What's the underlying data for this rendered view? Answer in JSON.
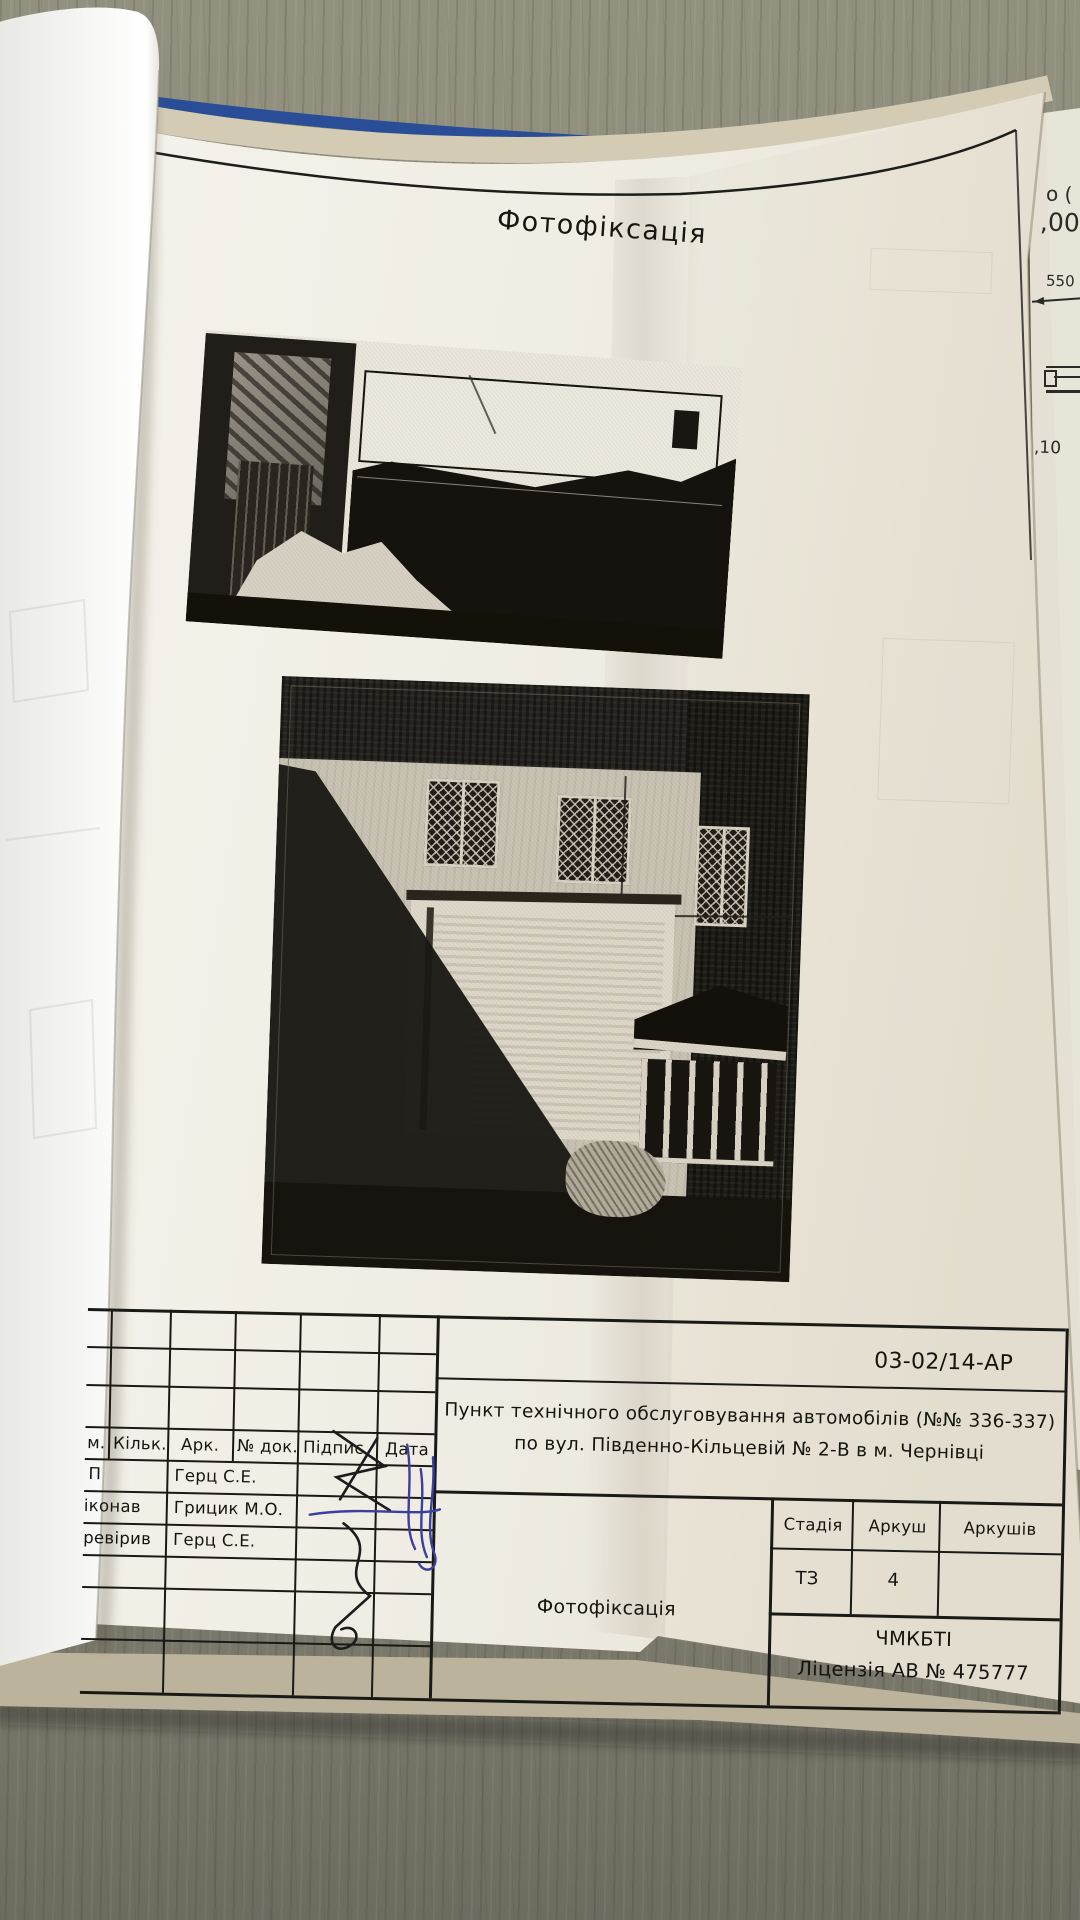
{
  "document": {
    "page_title": "Фотофіксація",
    "doc_code": "03-02/14-АР",
    "object_name_line1": "Пункт технічного обслуговування автомобілів (№№ 336-337)",
    "object_name_line2": "по вул. Південно-Кільцевій № 2-В в м. Чернівці",
    "sheet_label": "Фотофіксація",
    "org_name": "ЧМКБТІ",
    "org_license": "Ліцензія АВ № 475777"
  },
  "titleblock": {
    "headers": [
      "м.",
      "Кільк.",
      "Арк.",
      "№ док.",
      "Підпис",
      "Дата"
    ],
    "rows": [
      {
        "role": "П",
        "name": "Герц С.Е."
      },
      {
        "role": "іконав",
        "name": "Грицик М.О."
      },
      {
        "role": "ревірив",
        "name": "Герц С.Е."
      }
    ],
    "stage_headers": [
      "Стадія",
      "Аркуш",
      "Аркушів"
    ],
    "stage_values": [
      "ТЗ",
      "4",
      ""
    ]
  },
  "edge_fragments": {
    "f1": "о (",
    "f2": ",00",
    "f3": "550",
    "f4": ",10"
  },
  "colors": {
    "binder_blue": "#2a4d97",
    "table_surface": "#8c8b7c",
    "page_paper": "#f1eee6",
    "ink": "#191915",
    "pen_blue": "#3b3f9e"
  }
}
